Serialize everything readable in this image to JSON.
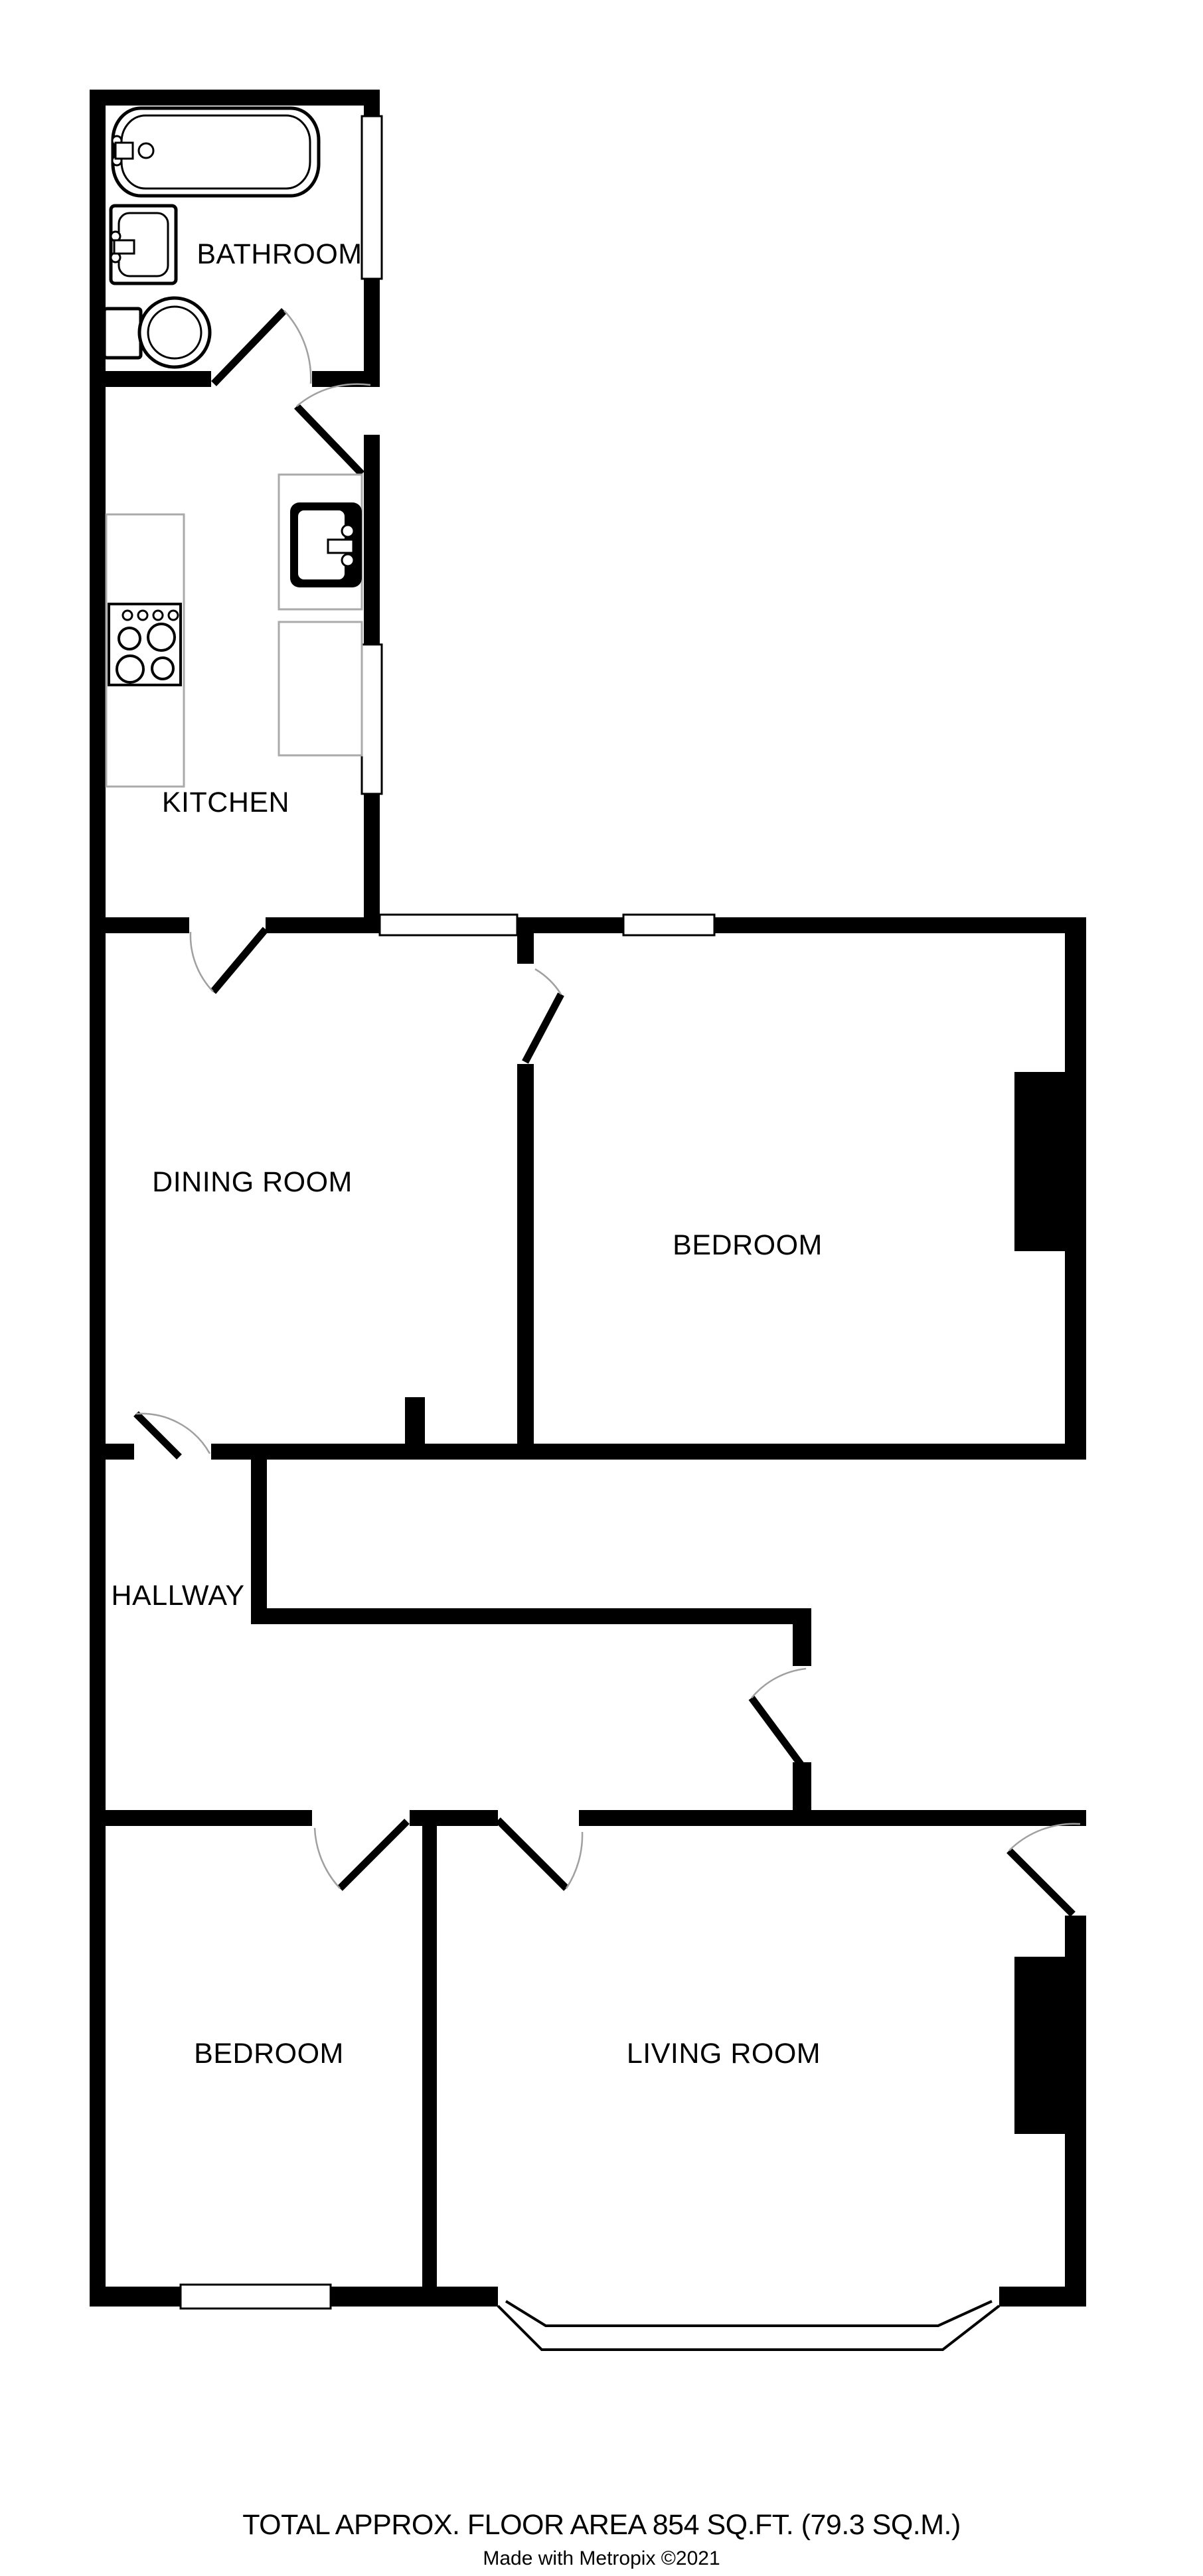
{
  "rooms": {
    "bathroom": {
      "label": "BATHROOM"
    },
    "kitchen": {
      "label": "KITCHEN"
    },
    "dining_room": {
      "label": "DINING ROOM"
    },
    "bedroom_1": {
      "label": "BEDROOM"
    },
    "hallway": {
      "label": "HALLWAY"
    },
    "bedroom_2": {
      "label": "BEDROOM"
    },
    "living_room": {
      "label": "LIVING ROOM"
    }
  },
  "footer": {
    "area_text": "TOTAL APPROX. FLOOR AREA 854 SQ.FT. (79.3 SQ.M.)",
    "credit_text": "Made with Metropix ©2021"
  },
  "fixtures": [
    "bathtub-icon",
    "bathroom-sink-icon",
    "toilet-icon",
    "stove-icon",
    "kitchen-sink-icon"
  ],
  "colors": {
    "wall": "#000000",
    "background": "#ffffff",
    "door_arc": "#a0a0a0",
    "counter_outline": "#aaaaaa"
  }
}
